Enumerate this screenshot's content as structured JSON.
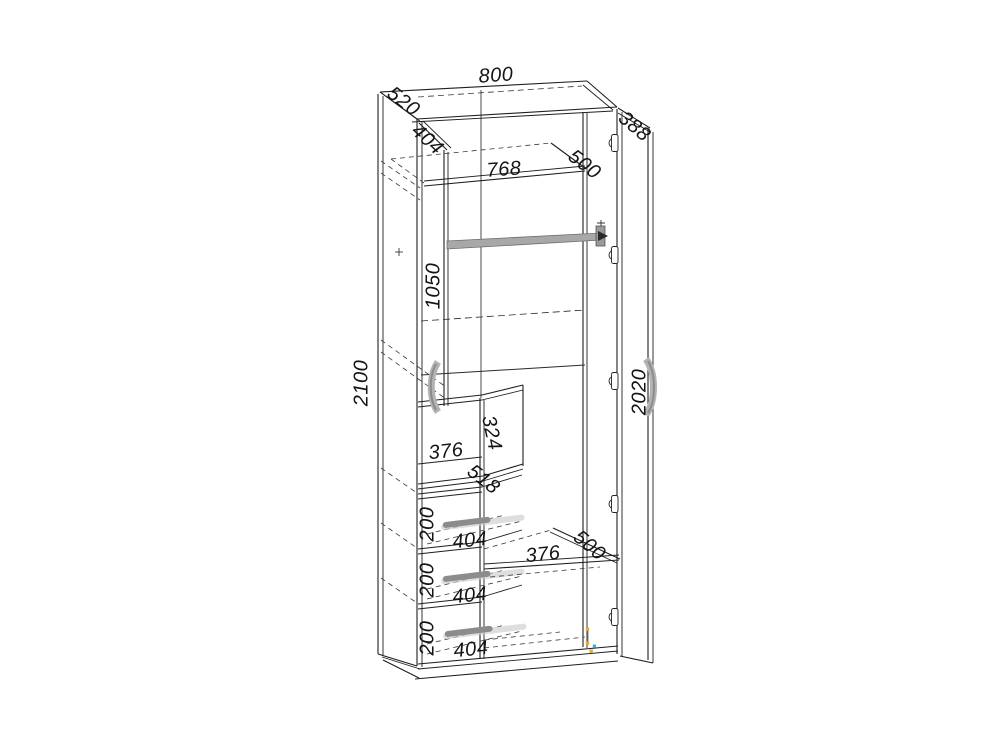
{
  "drawing": {
    "type": "furniture-technical-drawing",
    "subject": "two-door wardrobe with three drawers, shelves and hanging rod"
  },
  "dims": {
    "top_width": "800",
    "side_depth": "520",
    "left_door_width": "404",
    "top_shelf_width": "768",
    "top_shelf_depth": "500",
    "right_door_width": "388",
    "upper_section_height": "1050",
    "total_height": "2100",
    "door_height": "2020",
    "niche_height": "324",
    "niche_width": "376",
    "niche_depth": "518",
    "drawer1_height": "200",
    "drawer1_width": "404",
    "drawer2_height": "200",
    "drawer2_width": "404",
    "drawer3_height": "200",
    "drawer3_width": "404",
    "lower_shelf_width": "376",
    "lower_shelf_depth": "500"
  },
  "colors": {
    "line": "#1f1f1f",
    "hidden_line": "#3a3a3a",
    "hardware_gray": "#a8a8a8",
    "handle_dark": "#8c8c8c",
    "grip_orange": "#f5a623",
    "grip_cyan": "#35b6d9",
    "background": "#ffffff"
  }
}
